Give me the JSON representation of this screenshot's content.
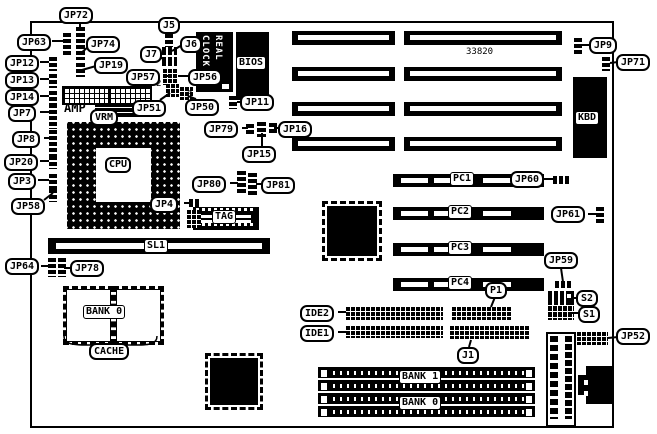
{
  "diagram_title": "motherboard jumper/connector location diagram",
  "rtc": {
    "line1": "REAL",
    "line2": "CLOCK"
  },
  "callouts": [
    {
      "id": "jp72",
      "t": "JP72",
      "x": 59,
      "y": 7
    },
    {
      "id": "jp63",
      "t": "JP63",
      "x": 17,
      "y": 34
    },
    {
      "id": "jp12",
      "t": "JP12",
      "x": 5,
      "y": 55
    },
    {
      "id": "jp13",
      "t": "JP13",
      "x": 5,
      "y": 72
    },
    {
      "id": "jp14",
      "t": "JP14",
      "x": 5,
      "y": 89
    },
    {
      "id": "jp7",
      "t": "JP7",
      "x": 8,
      "y": 105
    },
    {
      "id": "jp8",
      "t": "JP8",
      "x": 12,
      "y": 131
    },
    {
      "id": "jp20",
      "t": "JP20",
      "x": 4,
      "y": 154
    },
    {
      "id": "jp3",
      "t": "JP3",
      "x": 8,
      "y": 173
    },
    {
      "id": "jp58",
      "t": "JP58",
      "x": 11,
      "y": 198
    },
    {
      "id": "jp74",
      "t": "JP74",
      "x": 86,
      "y": 36
    },
    {
      "id": "jp19",
      "t": "JP19",
      "x": 94,
      "y": 57
    },
    {
      "id": "j5",
      "t": "J5",
      "x": 158,
      "y": 17
    },
    {
      "id": "j6",
      "t": "J6",
      "x": 180,
      "y": 36
    },
    {
      "id": "j7",
      "t": "J7",
      "x": 140,
      "y": 46
    },
    {
      "id": "jp57",
      "t": "JP57",
      "x": 126,
      "y": 69
    },
    {
      "id": "jp56",
      "t": "JP56",
      "x": 188,
      "y": 69
    },
    {
      "id": "jp51",
      "t": "JP51",
      "x": 132,
      "y": 100
    },
    {
      "id": "jp50",
      "t": "JP50",
      "x": 185,
      "y": 99
    },
    {
      "id": "jp11",
      "t": "JP11",
      "x": 240,
      "y": 94
    },
    {
      "id": "jp79",
      "t": "JP79",
      "x": 204,
      "y": 121
    },
    {
      "id": "jp16",
      "t": "JP16",
      "x": 278,
      "y": 121
    },
    {
      "id": "jp15",
      "t": "JP15",
      "x": 242,
      "y": 146
    },
    {
      "id": "jp80",
      "t": "JP80",
      "x": 192,
      "y": 176
    },
    {
      "id": "jp81",
      "t": "JP81",
      "x": 261,
      "y": 177
    },
    {
      "id": "jp4",
      "t": "JP4",
      "x": 150,
      "y": 196
    },
    {
      "id": "vrm",
      "t": "VRM",
      "x": 90,
      "y": 109
    },
    {
      "id": "jp64",
      "t": "JP64",
      "x": 5,
      "y": 258
    },
    {
      "id": "jp78",
      "t": "JP78",
      "x": 70,
      "y": 260
    },
    {
      "id": "cache",
      "t": "CACHE",
      "x": 89,
      "y": 343
    },
    {
      "id": "ide2",
      "t": "IDE2",
      "x": 300,
      "y": 305
    },
    {
      "id": "ide1",
      "t": "IDE1",
      "x": 300,
      "y": 325
    },
    {
      "id": "p1",
      "t": "P1",
      "x": 485,
      "y": 282
    },
    {
      "id": "j1",
      "t": "J1",
      "x": 457,
      "y": 347
    },
    {
      "id": "jp9",
      "t": "JP9",
      "x": 589,
      "y": 37
    },
    {
      "id": "jp71",
      "t": "JP71",
      "x": 616,
      "y": 54
    },
    {
      "id": "jp60",
      "t": "JP60",
      "x": 510,
      "y": 171
    },
    {
      "id": "jp61",
      "t": "JP61",
      "x": 551,
      "y": 206
    },
    {
      "id": "jp59",
      "t": "JP59",
      "x": 544,
      "y": 252
    },
    {
      "id": "s2",
      "t": "S2",
      "x": 576,
      "y": 290
    },
    {
      "id": "s1",
      "t": "S1",
      "x": 578,
      "y": 306
    },
    {
      "id": "jp52",
      "t": "JP52",
      "x": 616,
      "y": 328
    }
  ],
  "boxlabels": [
    {
      "id": "kbd",
      "t": "KBD",
      "x": 575,
      "y": 111,
      "r": 0
    },
    {
      "id": "pc1",
      "t": "PC1",
      "x": 450,
      "y": 172,
      "r": 0
    },
    {
      "id": "pc2",
      "t": "PC2",
      "x": 448,
      "y": 205,
      "r": 0
    },
    {
      "id": "pc3",
      "t": "PC3",
      "x": 448,
      "y": 241,
      "r": 0
    },
    {
      "id": "pc4",
      "t": "PC4",
      "x": 448,
      "y": 276,
      "r": 0
    },
    {
      "id": "sl1",
      "t": "SL1",
      "x": 144,
      "y": 239,
      "r": 0
    },
    {
      "id": "cpu",
      "t": "CPU",
      "x": 105,
      "y": 157,
      "r": 1
    },
    {
      "id": "tag",
      "t": "TAG",
      "x": 212,
      "y": 210,
      "r": 0
    },
    {
      "id": "bios",
      "t": "BIOS",
      "x": 236,
      "y": 56,
      "r": 0
    },
    {
      "id": "bank0-cache",
      "t": "BANK 0",
      "x": 83,
      "y": 305,
      "r": 0
    },
    {
      "id": "bank1-simm",
      "t": "BANK 1",
      "x": 399,
      "y": 370,
      "r": 0
    },
    {
      "id": "bank0-simm",
      "t": "BANK 0",
      "x": 399,
      "y": 396,
      "r": 0
    }
  ],
  "texts": [
    {
      "id": "chip-33820",
      "t": "33820",
      "x": 466,
      "y": 47,
      "b": 0
    },
    {
      "id": "num-2",
      "t": "2",
      "x": 156,
      "y": 79,
      "b": 0
    },
    {
      "id": "num-3",
      "t": "3",
      "x": 187,
      "y": 90,
      "b": 0
    },
    {
      "id": "amp",
      "t": "AMP",
      "x": 64,
      "y": 101,
      "b": 1
    }
  ],
  "jumpers": [
    {
      "k": "v",
      "x": 76,
      "y": 27,
      "w": 9,
      "h": 33
    },
    {
      "k": "v",
      "x": 76,
      "y": 63,
      "w": 9,
      "h": 14
    },
    {
      "k": "v",
      "x": 63,
      "y": 33,
      "w": 8,
      "h": 22
    },
    {
      "k": "v",
      "x": 49,
      "y": 57,
      "w": 8,
      "h": 14
    },
    {
      "k": "v",
      "x": 49,
      "y": 74,
      "w": 8,
      "h": 14
    },
    {
      "k": "v",
      "x": 49,
      "y": 91,
      "w": 8,
      "h": 15
    },
    {
      "k": "v",
      "x": 49,
      "y": 104,
      "w": 8,
      "h": 25
    },
    {
      "k": "v",
      "x": 49,
      "y": 130,
      "w": 8,
      "h": 26
    },
    {
      "k": "v",
      "x": 49,
      "y": 156,
      "w": 8,
      "h": 13
    },
    {
      "k": "v",
      "x": 49,
      "y": 174,
      "w": 8,
      "h": 15
    },
    {
      "k": "v",
      "x": 49,
      "y": 189,
      "w": 8,
      "h": 13
    },
    {
      "k": "v",
      "x": 165,
      "y": 34,
      "w": 8,
      "h": 13
    },
    {
      "k": "h",
      "x": 162,
      "y": 47,
      "w": 15,
      "h": 8
    },
    {
      "k": "h",
      "x": 162,
      "y": 57,
      "w": 15,
      "h": 9
    },
    {
      "k": "g",
      "x": 163,
      "y": 69,
      "w": 15,
      "h": 16
    },
    {
      "k": "g",
      "x": 166,
      "y": 84,
      "w": 13,
      "h": 13
    },
    {
      "k": "g",
      "x": 180,
      "y": 87,
      "w": 13,
      "h": 13
    },
    {
      "k": "v",
      "x": 229,
      "y": 96,
      "w": 8,
      "h": 13
    },
    {
      "k": "v",
      "x": 246,
      "y": 124,
      "w": 8,
      "h": 11
    },
    {
      "k": "v",
      "x": 257,
      "y": 122,
      "w": 9,
      "h": 15
    },
    {
      "k": "v",
      "x": 269,
      "y": 123,
      "w": 8,
      "h": 11
    },
    {
      "k": "v",
      "x": 237,
      "y": 171,
      "w": 9,
      "h": 24
    },
    {
      "k": "v",
      "x": 248,
      "y": 173,
      "w": 9,
      "h": 24
    },
    {
      "k": "h",
      "x": 189,
      "y": 199,
      "w": 11,
      "h": 8
    },
    {
      "k": "g",
      "x": 187,
      "y": 210,
      "w": 14,
      "h": 18
    },
    {
      "k": "v",
      "x": 574,
      "y": 38,
      "w": 8,
      "h": 16
    },
    {
      "k": "v",
      "x": 602,
      "y": 57,
      "w": 8,
      "h": 14
    },
    {
      "k": "h",
      "x": 553,
      "y": 176,
      "w": 18,
      "h": 8
    },
    {
      "k": "v",
      "x": 596,
      "y": 207,
      "w": 8,
      "h": 17
    },
    {
      "k": "h",
      "x": 555,
      "y": 281,
      "w": 18,
      "h": 7
    },
    {
      "k": "v",
      "x": 48,
      "y": 258,
      "w": 8,
      "h": 19
    },
    {
      "k": "v",
      "x": 58,
      "y": 258,
      "w": 8,
      "h": 19
    },
    {
      "k": "g",
      "x": 346,
      "y": 307,
      "w": 97,
      "h": 13
    },
    {
      "k": "g",
      "x": 346,
      "y": 326,
      "w": 97,
      "h": 12
    },
    {
      "k": "g",
      "x": 452,
      "y": 307,
      "w": 60,
      "h": 13
    },
    {
      "k": "g",
      "x": 450,
      "y": 326,
      "w": 80,
      "h": 13
    },
    {
      "k": "g",
      "x": 577,
      "y": 332,
      "w": 31,
      "h": 13
    }
  ],
  "leaders": [
    [
      80,
      22,
      80,
      28
    ],
    [
      52,
      41,
      63,
      41
    ],
    [
      40,
      62,
      49,
      62
    ],
    [
      40,
      79,
      49,
      79
    ],
    [
      40,
      96,
      49,
      96
    ],
    [
      40,
      112,
      49,
      112
    ],
    [
      44,
      138,
      49,
      138
    ],
    [
      40,
      161,
      49,
      161
    ],
    [
      38,
      180,
      49,
      180
    ],
    [
      44,
      200,
      53,
      193
    ],
    [
      88,
      47,
      80,
      54
    ],
    [
      96,
      66,
      82,
      70
    ],
    [
      166,
      76,
      172,
      76
    ],
    [
      168,
      31,
      168,
      36
    ],
    [
      182,
      45,
      172,
      51
    ],
    [
      156,
      53,
      164,
      60
    ],
    [
      190,
      76,
      178,
      76
    ],
    [
      160,
      100,
      170,
      93
    ],
    [
      196,
      99,
      188,
      96
    ],
    [
      241,
      102,
      237,
      102
    ],
    [
      242,
      128,
      248,
      128
    ],
    [
      280,
      128,
      274,
      128
    ],
    [
      262,
      147,
      262,
      133
    ],
    [
      230,
      183,
      238,
      183
    ],
    [
      262,
      184,
      256,
      184
    ],
    [
      184,
      203,
      190,
      203
    ],
    [
      591,
      45,
      582,
      45
    ],
    [
      618,
      62,
      610,
      63
    ],
    [
      544,
      179,
      554,
      179
    ],
    [
      588,
      214,
      596,
      214
    ],
    [
      561,
      268,
      563,
      282
    ],
    [
      578,
      298,
      572,
      298
    ],
    [
      580,
      313,
      572,
      313
    ],
    [
      618,
      337,
      608,
      338
    ],
    [
      41,
      266,
      48,
      266
    ],
    [
      70,
      268,
      64,
      268
    ],
    [
      338,
      312,
      346,
      312
    ],
    [
      338,
      332,
      346,
      332
    ],
    [
      495,
      297,
      491,
      307
    ],
    [
      469,
      347,
      471,
      340
    ]
  ]
}
